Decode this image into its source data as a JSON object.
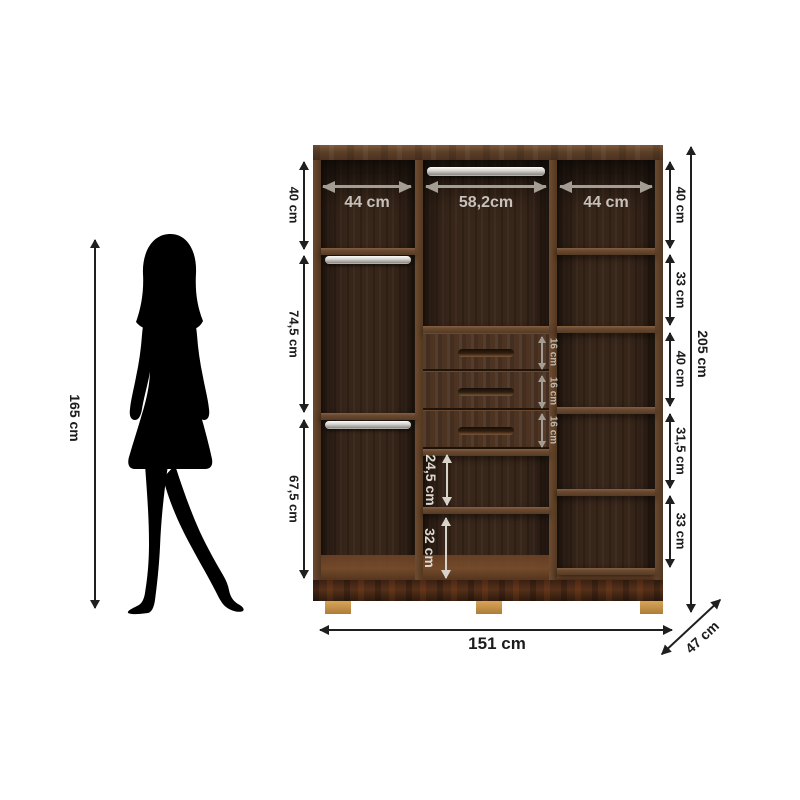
{
  "person": {
    "height_label": "165 cm"
  },
  "wardrobe": {
    "top_widths": [
      "44 cm",
      "58,2cm",
      "44 cm"
    ],
    "left_heights": [
      "40 cm",
      "74,5 cm",
      "67,5 cm"
    ],
    "right_heights": [
      "40 cm",
      "33 cm",
      "40 cm",
      "31,5 cm",
      "33 cm"
    ],
    "drawer_heights": [
      "16 cm",
      "16 cm",
      "16 cm"
    ],
    "center_heights": [
      "24,5 cm",
      "32 cm"
    ],
    "overall_height": "205 cm",
    "overall_width": "151 cm",
    "overall_depth": "47 cm"
  },
  "colors": {
    "background": "#ffffff",
    "silhouette": "#000000",
    "dimension_dark": "#1f1f1f",
    "dimension_light": "#c7c1b9",
    "wood_frame": "#5d3f28",
    "wood_interior": "#38261a",
    "wood_base": "#44291a",
    "feet": "#c08c44",
    "rod": "#e9e8e6"
  }
}
